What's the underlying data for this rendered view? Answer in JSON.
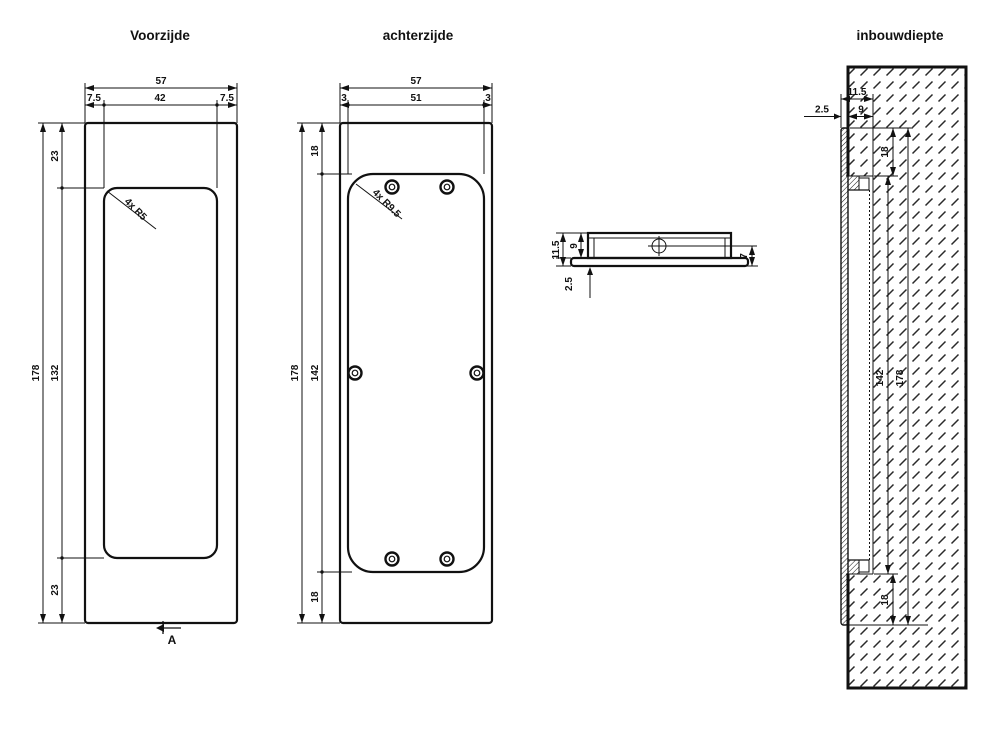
{
  "drawing": {
    "front": {
      "title": "Voorzijde",
      "w_total": "57",
      "w_left": "7.5",
      "w_inner": "42",
      "w_right": "7.5",
      "h_total": "178",
      "h_top": "23",
      "h_inner": "132",
      "h_bottom": "23",
      "corner_note": "4x R5",
      "section_label": "A"
    },
    "back": {
      "title": "achterzijde",
      "w_total": "57",
      "w_left": "3",
      "w_inner": "51",
      "w_right": "3",
      "h_total": "178",
      "h_top": "18",
      "h_inner": "142",
      "h_bottom": "18",
      "corner_note": "4x R9.5"
    },
    "side": {
      "t_total": "11.5",
      "t_body": "9",
      "t_flange": "2.5",
      "d_inset": "7"
    },
    "depth": {
      "title": "inbouwdiepte",
      "d_total": "11.5",
      "d_recess": "9",
      "d_flange": "2.5",
      "h_top": "18",
      "h_inner": "142",
      "h_total": "178",
      "h_bottom": "18"
    },
    "colors": {
      "line": "#111111",
      "background": "#ffffff"
    }
  }
}
